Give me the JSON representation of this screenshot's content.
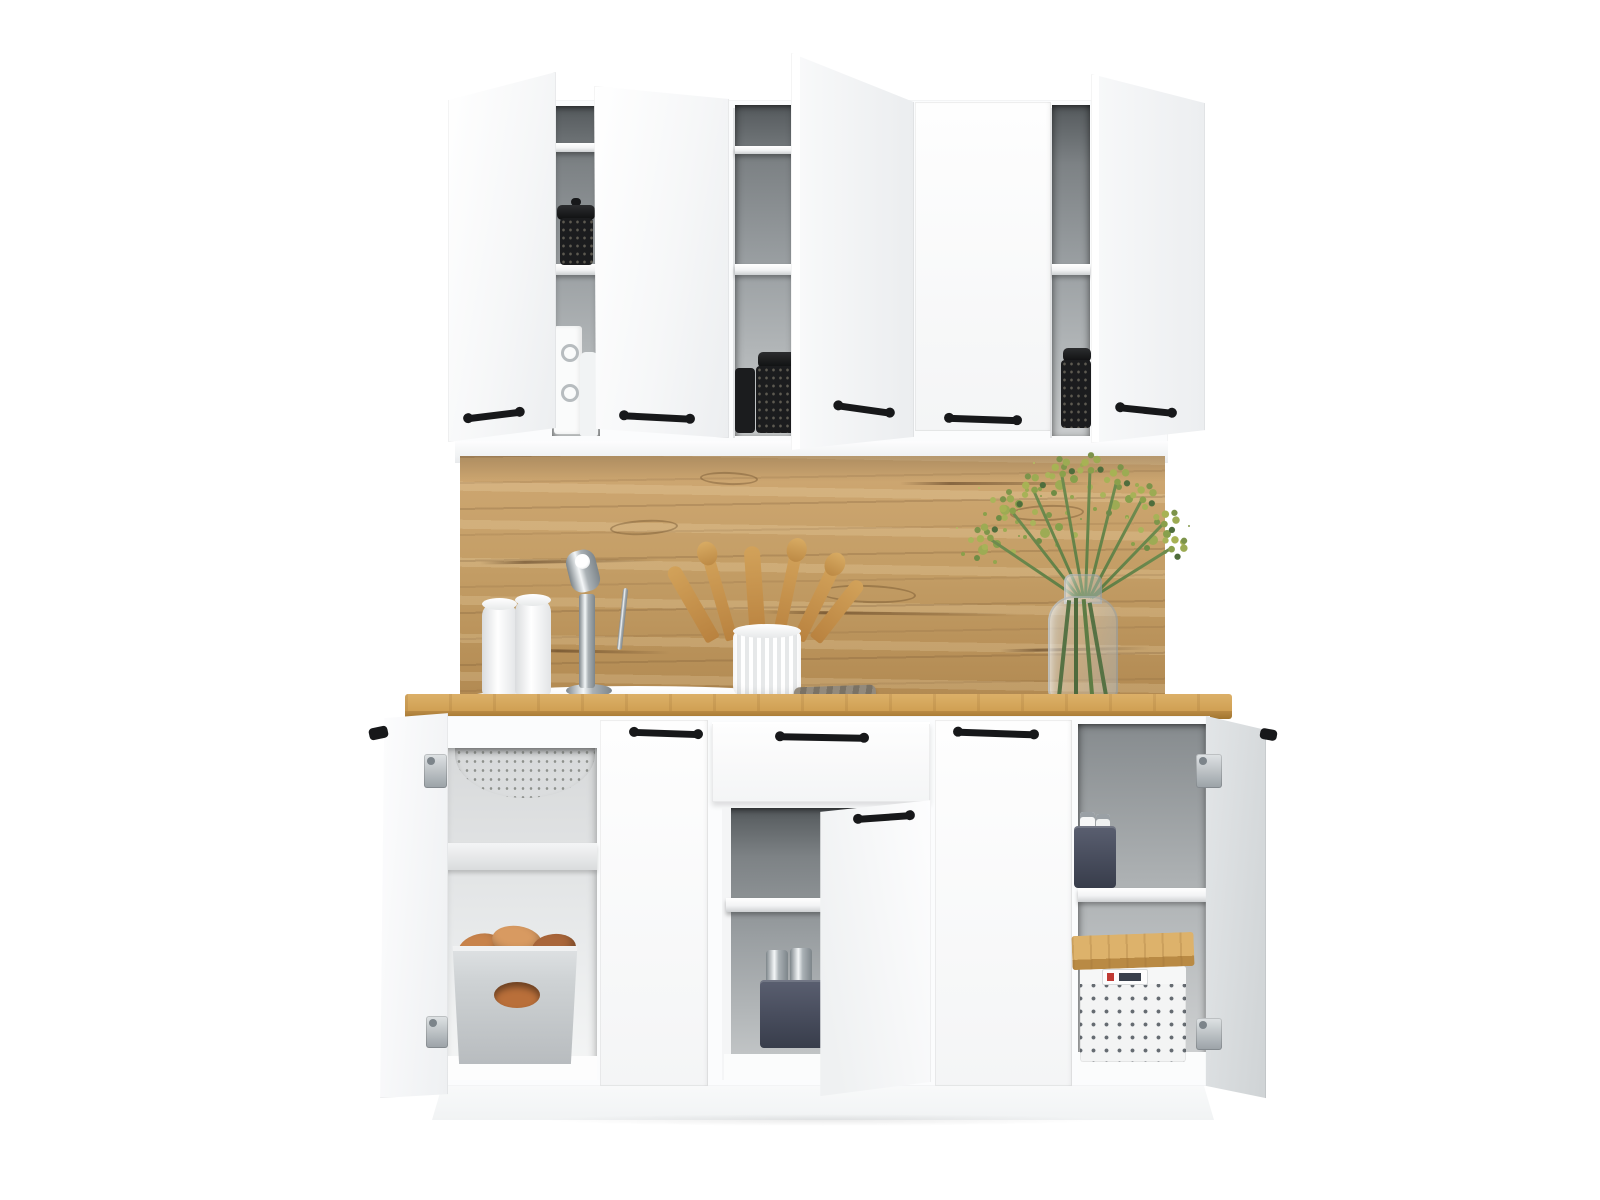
{
  "meta": {
    "type": "product-photo",
    "subject": "Compact white kitchen cabinet set, front view, all doors open showing storage",
    "background": "#ffffff"
  },
  "palette": {
    "bg": "#ffffff",
    "cabinet": "#fbfcfd",
    "cabinet-shade": "#eceef0",
    "shelf": "#f2f3f4",
    "interior-top": "#54595c",
    "interior-mid": "#9a9fa2",
    "interior-light": "#c9cccd",
    "wood-hi": "#cfa873",
    "wood-mid": "#c49e66",
    "wood-low": "#b28a52",
    "counter-hi": "#dcb068",
    "counter-mid": "#cf9f52",
    "counter-edge": "#a1752f",
    "handle": "#17181a",
    "chrome-hi": "#f4f7f8",
    "chrome-mid": "#aab1b5",
    "chrome-low": "#7d858a",
    "jar": "#1b1c1e",
    "potato": "#c8834b",
    "potato-dark": "#a9663a",
    "potato-light": "#d89a61",
    "basket-light": "#ced2d4",
    "basket-slate": "#474c5c",
    "basket-white": "#f3f4f4",
    "basket-dot": "#656b71",
    "lid-wood": "#d1a45f",
    "plant-leaf": "#4f6d3c",
    "plant-bud": "#a7b254",
    "plant-stem": "#5d7c44",
    "towel": "#8d8475",
    "glass": "#ccd3d6"
  },
  "objects": {
    "wall_cabinets": {
      "count": 3,
      "doors_open": 4,
      "doors_closed": 1,
      "handle_style": "black bar pulls",
      "contents": [
        "black storage jars",
        "white containers"
      ]
    },
    "backsplash": "oak wood panel with grain knots",
    "countertop": "oak wood worktop",
    "counter_items": [
      "inset white sink",
      "chrome single-lever faucet",
      "two white paper towel rolls",
      "ribbed white crock with wooden utensils",
      "folded grey kitchen towel",
      "glass vase with green sprigs"
    ],
    "base_cabinets": {
      "doors_open": 3,
      "doors_closed": 2,
      "drawers": 1,
      "contents": [
        "under-sink basin",
        "grey bin with sweet potatoes",
        "slate basket with jars",
        "slate basket with white jars",
        "white perforated basket with wooden lid"
      ]
    },
    "plinth": "white toe-kick"
  }
}
